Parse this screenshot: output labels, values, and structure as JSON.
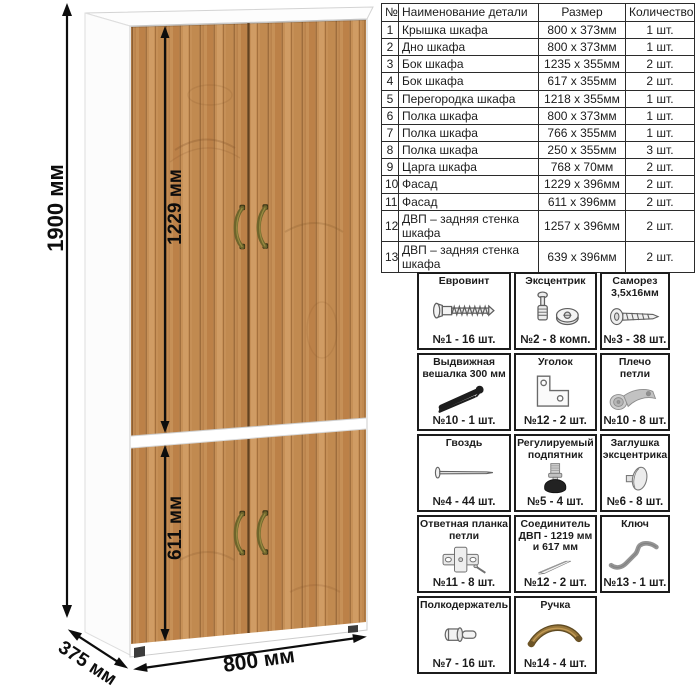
{
  "dimensions": {
    "height": "1900 мм",
    "facade_upper": "1229 мм",
    "facade_lower": "611 мм",
    "width": "800 мм",
    "depth": "375 мм"
  },
  "parts_table": {
    "headers": [
      "№",
      "Наименование детали",
      "Размер",
      "Количество"
    ],
    "rows": [
      [
        "1",
        "Крышка шкафа",
        "800 x 373мм",
        "1 шт."
      ],
      [
        "2",
        "Дно шкафа",
        "800 x 373мм",
        "1 шт."
      ],
      [
        "3",
        "Бок шкафа",
        "1235 x 355мм",
        "2 шт."
      ],
      [
        "4",
        "Бок шкафа",
        "617 x 355мм",
        "2 шт."
      ],
      [
        "5",
        "Перегородка шкафа",
        "1218 x 355мм",
        "1 шт."
      ],
      [
        "6",
        "Полка шкафа",
        "800 x 373мм",
        "1 шт."
      ],
      [
        "7",
        "Полка шкафа",
        "766 x 355мм",
        "1 шт."
      ],
      [
        "8",
        "Полка шкафа",
        "250 x 355мм",
        "3 шт."
      ],
      [
        "9",
        "Царга шкафа",
        "768 x 70мм",
        "2 шт."
      ],
      [
        "10",
        "Фасад",
        "1229 x 396мм",
        "2 шт."
      ],
      [
        "11",
        "Фасад",
        "611 x 396мм",
        "2 шт."
      ],
      [
        "12",
        "ДВП – задняя стенка шкафа",
        "1257 x 396мм",
        "2 шт."
      ],
      [
        "13",
        "ДВП – задняя стенка шкафа",
        "639 x 396мм",
        "2 шт."
      ]
    ]
  },
  "hardware": {
    "items": [
      {
        "name": "Евровинт",
        "icon": "euro-screw",
        "count": "№1 - 16 шт."
      },
      {
        "name": "Эксцентрик",
        "icon": "eccentric-cam",
        "count": "№2 - 8 комп."
      },
      {
        "name": "Саморез 3,5х16мм",
        "icon": "screw",
        "count": "№3 - 38 шт."
      },
      {
        "name": "Выдвижная вешалка 300 мм",
        "icon": "pull-out-hanger",
        "count": "№10 - 1 шт."
      },
      {
        "name": "Уголок",
        "icon": "corner-bracket",
        "count": "№12 - 2 шт."
      },
      {
        "name": "Плечо петли",
        "icon": "hinge-arm",
        "count": "№10 - 8 шт."
      },
      {
        "name": "Гвоздь",
        "icon": "nail",
        "count": "№4 - 44 шт."
      },
      {
        "name": "Регулируемый подпятник",
        "icon": "adjustable-foot",
        "count": "№5 - 4 шт."
      },
      {
        "name": "Заглушка эксцентрика",
        "icon": "cam-cap",
        "count": "№6 - 8 шт."
      },
      {
        "name": "Ответная планка петли",
        "icon": "hinge-plate",
        "count": "№11 - 8 шт."
      },
      {
        "name": "Соединитель ДВП - 1219 мм и 617 мм",
        "icon": "hdf-connector",
        "count": "№12 - 2 шт."
      },
      {
        "name": "Ключ",
        "icon": "hex-key",
        "count": "№13 - 1 шт."
      },
      {
        "name": "Полкодержатель",
        "icon": "shelf-pin",
        "count": "№7 - 16 шт."
      },
      {
        "name": "Ручка",
        "icon": "handle",
        "count": "№14 - 4 шт."
      }
    ]
  },
  "colors": {
    "wood": "#c69057",
    "wood_dark": "#9e6d3c",
    "carcass": "#ffffff",
    "handle": "#6e642b",
    "line": "#1c1c1c"
  }
}
